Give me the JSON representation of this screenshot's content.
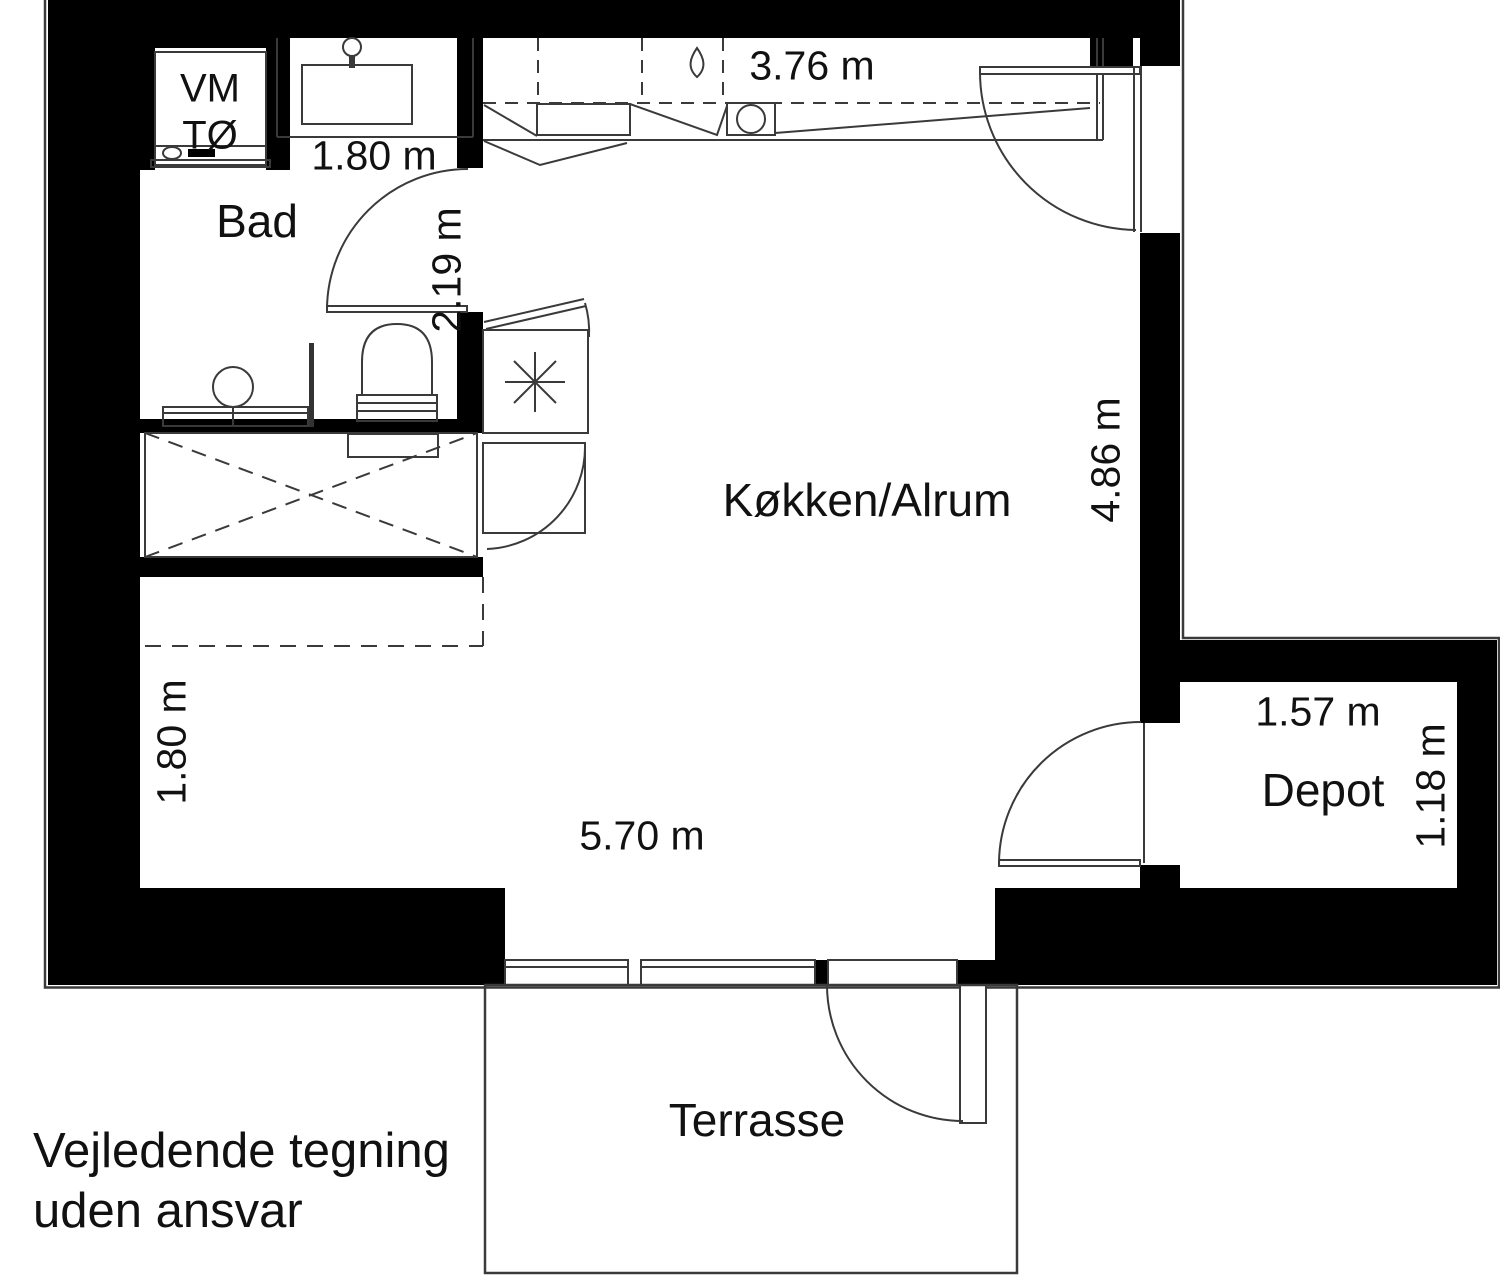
{
  "rooms": {
    "bathroom": "Bad",
    "kitchen_livingroom": "Køkken/Alrum",
    "storage": "Depot",
    "terrace": "Terrasse"
  },
  "appliances": {
    "washing_machine": "VM",
    "tumble_dryer": "TØ"
  },
  "dimensions": {
    "bathroom_width": "1.80 m",
    "bathroom_depth": "2.19 m",
    "kitchen_width": "3.76 m",
    "livingroom_depth": "4.86 m",
    "livingroom_width": "5.70 m",
    "entry_width": "1.80 m",
    "storage_width": "1.57 m",
    "storage_depth": "1.18 m"
  },
  "disclaimer": {
    "line1": "Vejledende tegning",
    "line2": "uden ansvar"
  },
  "colors": {
    "wall": "#000000",
    "line": "#3a3a3a",
    "background": "#ffffff",
    "text": "#111111"
  }
}
